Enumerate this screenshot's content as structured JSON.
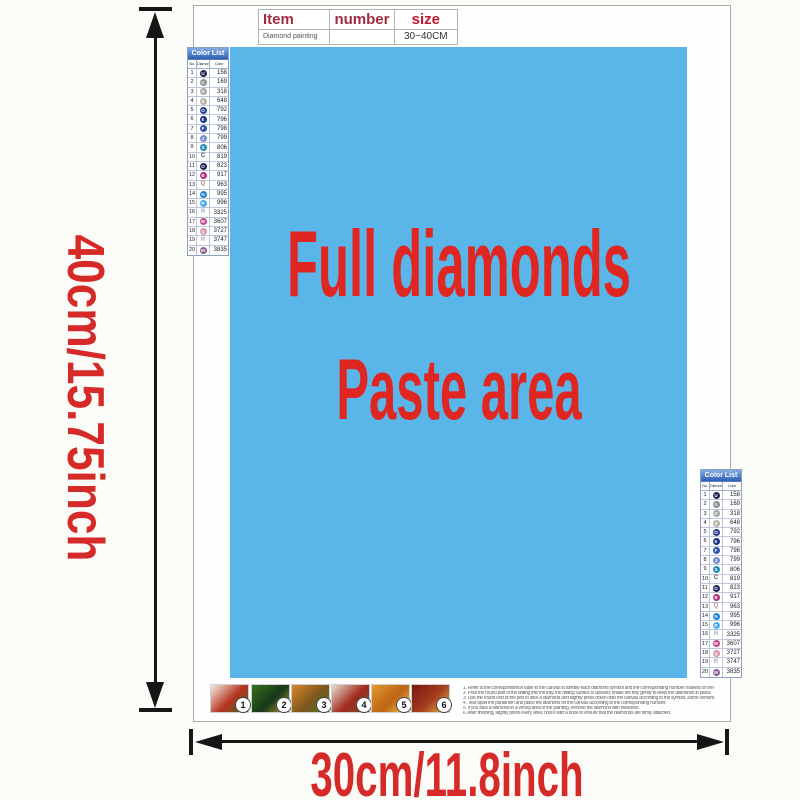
{
  "item_table": {
    "headers": {
      "item": "Item",
      "number": "number",
      "size": "size"
    },
    "row": {
      "item": "Diamond painting",
      "number": "",
      "size": "30~40CM"
    }
  },
  "paste_area": {
    "line1": "Full diamonds",
    "line2": "Paste area"
  },
  "dimensions": {
    "height": "40cm/15.75inch",
    "width": "30cm/11.8inch"
  },
  "colors": {
    "paste_bg": "#5ab6e8",
    "title_red": "#e02621",
    "dim_red": "#d52a28",
    "list_header_blue": "#2d5fb6"
  },
  "color_list": {
    "title": "Color List",
    "columns": [
      "No.",
      "Diamond",
      "Color"
    ],
    "rows": [
      {
        "no": "1",
        "symbol": "U",
        "code": "158",
        "hex": "#1d2152",
        "style": "circle"
      },
      {
        "no": "2",
        "symbol": "G",
        "code": "169",
        "hex": "#8b8b8b",
        "style": "circle"
      },
      {
        "no": "3",
        "symbol": "D",
        "code": "318",
        "hex": "#a3a3a3",
        "style": "circle"
      },
      {
        "no": "4",
        "symbol": "d",
        "code": "648",
        "hex": "#b7b3a6",
        "style": "circle"
      },
      {
        "no": "5",
        "symbol": "O",
        "code": "792",
        "hex": "#2c3e8f",
        "style": "circle"
      },
      {
        "no": "6",
        "symbol": "E",
        "code": "796",
        "hex": "#16307e",
        "style": "circle"
      },
      {
        "no": "7",
        "symbol": "F",
        "code": "798",
        "hex": "#2c55a8",
        "style": "circle"
      },
      {
        "no": "8",
        "symbol": "J",
        "code": "799",
        "hex": "#7591cf",
        "style": "circle"
      },
      {
        "no": "9",
        "symbol": "S",
        "code": "806",
        "hex": "#1f8db5",
        "style": "circle"
      },
      {
        "no": "10",
        "symbol": "C",
        "code": "819",
        "hex": "#555555",
        "style": "letter"
      },
      {
        "no": "11",
        "symbol": "O",
        "code": "823",
        "hex": "#1b2558",
        "style": "circle"
      },
      {
        "no": "12",
        "symbol": "B",
        "code": "917",
        "hex": "#b02c7c",
        "style": "circle"
      },
      {
        "no": "13",
        "symbol": "Q",
        "code": "963",
        "hex": "#b98a8a",
        "style": "letter"
      },
      {
        "no": "14",
        "symbol": "N",
        "code": "995",
        "hex": "#1684d6",
        "style": "circle"
      },
      {
        "no": "15",
        "symbol": "P",
        "code": "996",
        "hex": "#47afe8",
        "style": "circle"
      },
      {
        "no": "16",
        "symbol": "R",
        "code": "3325",
        "hex": "#8fb6e0",
        "style": "letter"
      },
      {
        "no": "17",
        "symbol": "W",
        "code": "3607",
        "hex": "#c1418e",
        "style": "circle"
      },
      {
        "no": "18",
        "symbol": "Q",
        "code": "3727",
        "hex": "#d193ab",
        "style": "circle"
      },
      {
        "no": "19",
        "symbol": "R",
        "code": "3747",
        "hex": "#a9a9d0",
        "style": "letter"
      },
      {
        "no": "20",
        "symbol": "M",
        "code": "3835",
        "hex": "#8a5c93",
        "style": "circle"
      }
    ]
  },
  "steps": [
    {
      "num": "1",
      "colors": [
        "#f3efe4",
        "#b5331f",
        "#3f6b2b"
      ]
    },
    {
      "num": "2",
      "colors": [
        "#37701f",
        "#16381a",
        "#c19a36"
      ]
    },
    {
      "num": "3",
      "colors": [
        "#d8882a",
        "#7c551d",
        "#4d7c2e"
      ]
    },
    {
      "num": "4",
      "colors": [
        "#e9e0d0",
        "#a02a1d",
        "#7b4b28"
      ]
    },
    {
      "num": "5",
      "colors": [
        "#e19a2c",
        "#bd6314",
        "#f2c94d"
      ]
    },
    {
      "num": "6",
      "colors": [
        "#77180f",
        "#a63f1e",
        "#eac23d"
      ]
    }
  ],
  "instructions": {
    "lines": [
      "1.  Refer to the correspondence table to the canvas to identify each diamond symbol and the corresponding number marked on the canvas.",
      "2.  Pour the round part of the drilling into the tray, the drilling surface is upward; shake the tray gently to keep the diamonds in place.",
      "3.  Use the round end of the pen to stick a diamond and slightly press down onto the canvas according to the symbol, some cement.",
      "4.  Tear apart the partial film and place the diamond on the canvas according to the corresponding number.",
      "5.  If you stick a diamond in a wrong area of the painting, remove the diamond with tweezers.",
      "6.  After finishing, slightly press every area; hold it with a book to ensure that the diamonds are firmly attached."
    ]
  }
}
